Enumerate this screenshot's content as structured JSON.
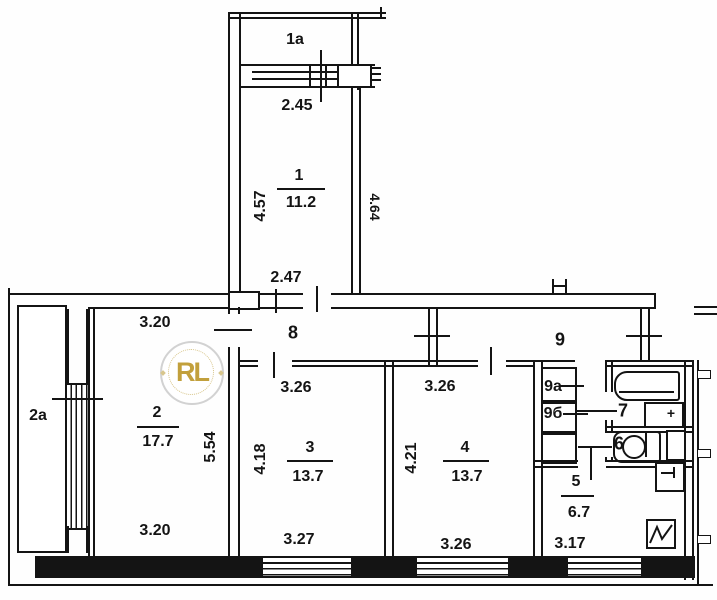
{
  "plan": {
    "upper_block": {
      "balcony": "1a",
      "balcony_width": "2.45",
      "room": {
        "number": "1",
        "area": "11.2"
      },
      "dim_left": "4.57",
      "dim_right": "4.64",
      "dim_bottom": "2.47"
    },
    "hall_left": "8",
    "hall_right": "9",
    "living_room": {
      "number": "2",
      "area": "17.7",
      "dim_top": "3.20",
      "dim_bottom": "3.20",
      "dim_side": "5.54"
    },
    "balcony_left": "2a",
    "bedroom_mid": {
      "number": "3",
      "area": "13.7",
      "dim_top": "3.26",
      "dim_bottom": "3.27",
      "dim_side": "4.18"
    },
    "bedroom_right": {
      "number": "4",
      "area": "13.7",
      "dim_top": "3.26",
      "dim_bottom": "3.26",
      "dim_side": "4.21"
    },
    "kitchen": {
      "number": "5",
      "area": "6.7",
      "dim_bottom": "3.17"
    },
    "wc": "6",
    "bathroom": "7",
    "closet_top": "9a",
    "closet_bottom": "9б",
    "sink_plus": "+"
  },
  "watermark": {
    "text": "RL"
  },
  "colors": {
    "line": "#141414",
    "gold": "#c2a03c",
    "ring": "#d2d2d2"
  }
}
